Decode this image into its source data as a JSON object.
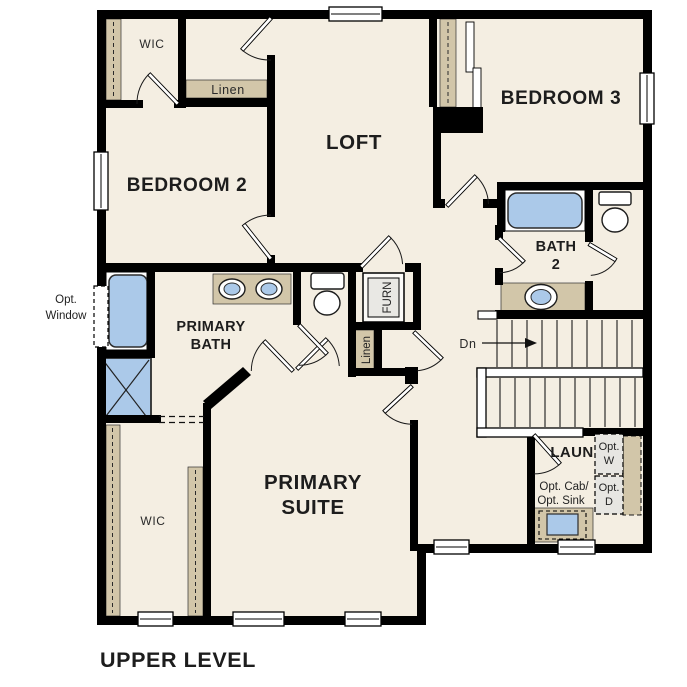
{
  "plan": {
    "title": "UPPER LEVEL"
  },
  "colors": {
    "wall": "#000000",
    "floor": "#f4eee2",
    "shelf_tan": "#d2c6a9",
    "fixture_blue": "#abc9e9",
    "optional_gray": "#e7e6e2",
    "text": "#1d1d1d",
    "background": "#ffffff"
  },
  "rooms": {
    "bedroom2": {
      "label": "BEDROOM 2"
    },
    "bedroom3": {
      "label": "BEDROOM 3"
    },
    "loft": {
      "label": "LOFT"
    },
    "bath2": {
      "line1": "BATH",
      "line2": "2"
    },
    "primary_bath": {
      "line1": "PRIMARY",
      "line2": "BATH"
    },
    "primary_suite": {
      "line1": "PRIMARY",
      "line2": "SUITE"
    },
    "laundry": {
      "label": "LAUN"
    }
  },
  "closets": {
    "wic_top": "WIC",
    "wic_bottom": "WIC",
    "linen_top": "Linen",
    "linen_hall": "Linen"
  },
  "utility": {
    "furnace": "FURN"
  },
  "stairs": {
    "down_label": "Dn"
  },
  "options": {
    "washer": {
      "line1": "Opt.",
      "line2": "W"
    },
    "dryer": {
      "line1": "Opt.",
      "line2": "D"
    },
    "cab_sink": {
      "line1": "Opt. Cab/",
      "line2": "Opt. Sink"
    },
    "window": {
      "line1": "Opt.",
      "line2": "Window"
    }
  }
}
